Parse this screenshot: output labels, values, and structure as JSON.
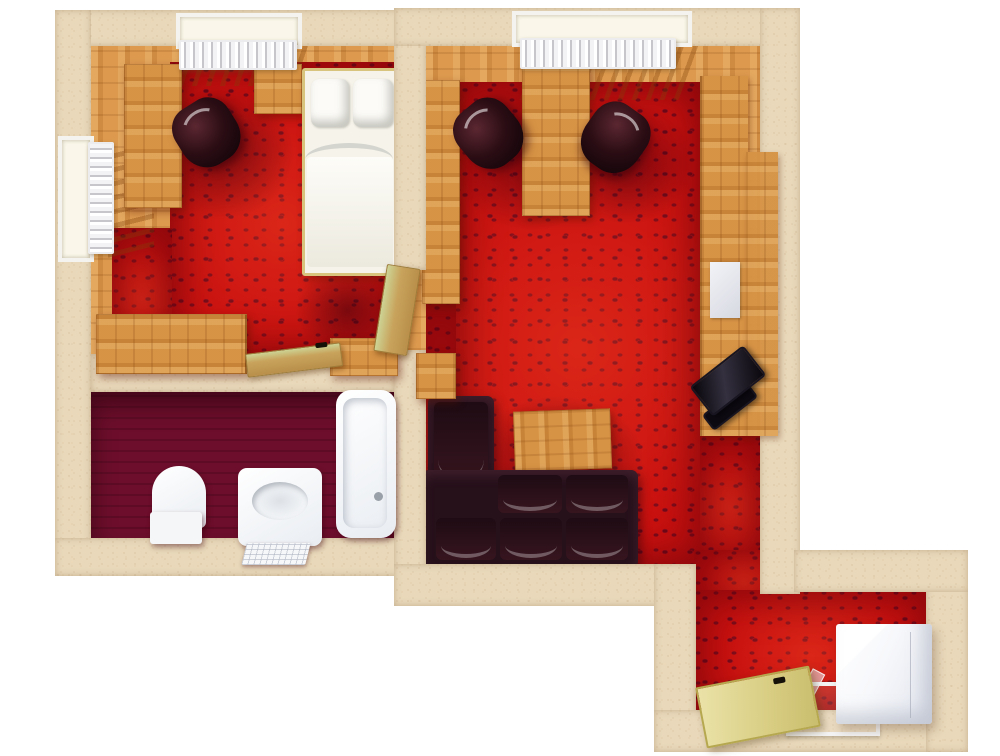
{
  "scene": {
    "kind": "3d-rendered-floor-plan",
    "view": "top-down",
    "background": "#ffffff",
    "text_content": "none"
  },
  "palette": {
    "wall_beige": "#e9d8ba",
    "wall_speckle": "#a88a5c",
    "wood_floor": "#d9964a",
    "wood_furniture": "#d28e3f",
    "carpet_red": "#c9100f",
    "carpet_motif_dark": "#6f0918",
    "carpet_shadow": "#580010",
    "bathroom_floor_maroon": "#6d0e2c",
    "fixture_white": "#f2f5f8",
    "bedding_white": "#f6f4ea",
    "sofa_dark": "#26101a",
    "chair_black": "#2b0d14",
    "tv_black": "#08060b",
    "door_tan_green": "#cdd495",
    "entry_door_yellow": "#e0d794",
    "radiator_white": "#f3f3f5"
  },
  "rooms": [
    {
      "name": "bedroom",
      "position": "top-left",
      "floor": "red patterned carpet over wood planks",
      "objects": [
        "north-window",
        "north-radiator",
        "west-window",
        "west-radiator",
        "desk-wardrobe",
        "office-chair",
        "nightstand",
        "single-bed-with-two-pillows",
        "sideboard",
        "wall-bench",
        "open-door"
      ]
    },
    {
      "name": "bathroom",
      "position": "bottom-left",
      "floor": "dark maroon",
      "objects": [
        "toilet",
        "washbasin",
        "bath-mat",
        "bathtub"
      ]
    },
    {
      "name": "living-room",
      "position": "right",
      "floor": "red patterned carpet over wood planks",
      "objects": [
        "north-window",
        "north-radiator",
        "left-desk",
        "center-desk",
        "office-chair-1",
        "office-chair-2",
        "wall-unit-front",
        "wall-unit-back",
        "white-panel",
        "tv",
        "side-cabinet",
        "coffee-table",
        "corner-sofa",
        "open-door"
      ]
    },
    {
      "name": "entry-hall",
      "position": "bottom-right",
      "floor": "red patterned carpet",
      "objects": [
        "white-cabinet-fridge",
        "entry-door-open",
        "entry-door-frame",
        "glass-pane"
      ]
    }
  ]
}
